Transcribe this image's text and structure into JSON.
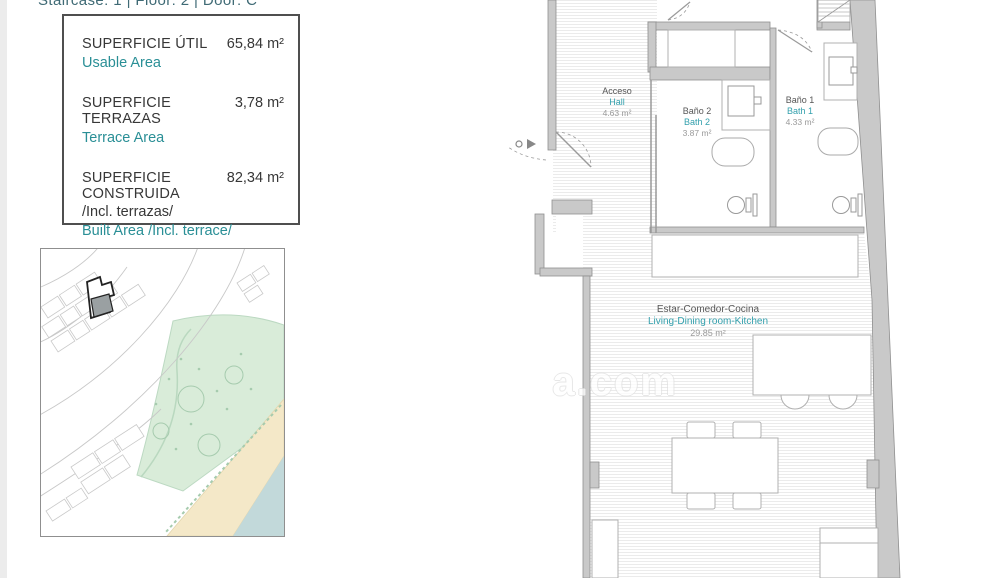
{
  "header": {
    "text": "Staircase: 1 | Floor: 2 | Door: C"
  },
  "area_box": {
    "rows": [
      {
        "title": "SUPERFICIE ÚTIL",
        "translation": "Usable Area",
        "value": "65,84 m²"
      },
      {
        "title": "SUPERFICIE TERRAZAS",
        "translation": "Terrace Area",
        "value": "3,78 m²"
      },
      {
        "title": "SUPERFICIE CONSTRUIDA",
        "subtitle": "/Incl. terrazas/",
        "translation": "Built Area /Incl. terrace/",
        "value": "82,34 m²"
      }
    ]
  },
  "floor_plan": {
    "rooms": {
      "hall": {
        "name_es": "Acceso",
        "name_en": "Hall",
        "area": "4.63 m²"
      },
      "bath2": {
        "name_es": "Baño 2",
        "name_en": "Bath 2",
        "area": "3.87 m²"
      },
      "bath1": {
        "name_es": "Baño 1",
        "name_en": "Bath 1",
        "area": "4.33 m²"
      },
      "living": {
        "name_es": "Estar-Comedor-Cocina",
        "name_en": "Living-Dining room-Kitchen",
        "area": "29.85 m²"
      }
    }
  },
  "watermark": {
    "visible_text": "a.com"
  },
  "colors": {
    "accent_teal": "#2a8f96",
    "header_teal": "#3f6a75",
    "wall_gray": "#c9c9c9",
    "park_green": "#d9ecd9",
    "sand": "#f4e8c8",
    "sea": "#c2d9da",
    "highlighted_building": "#9aa0a2"
  }
}
